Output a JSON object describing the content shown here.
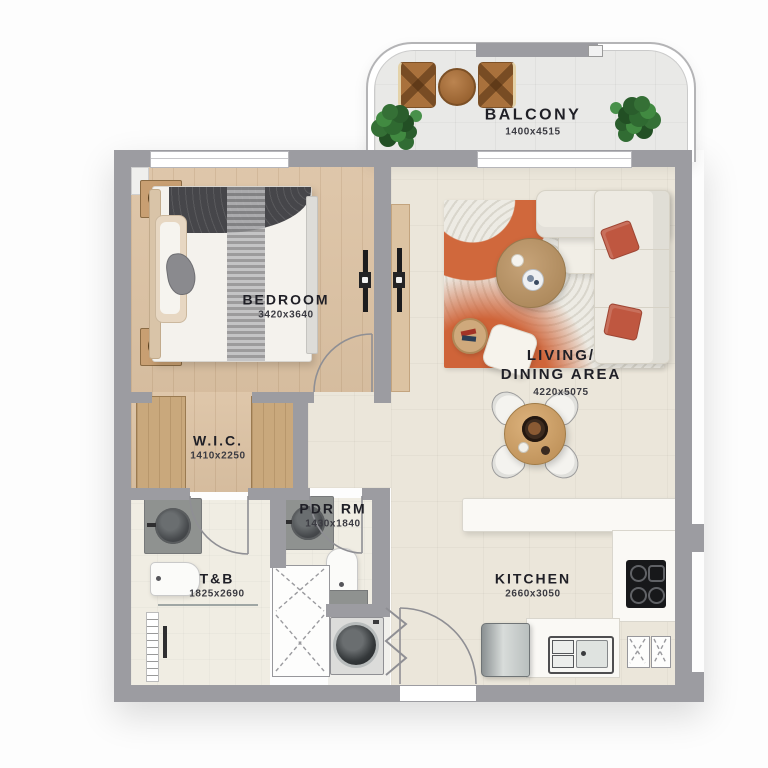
{
  "title": "Apartment floor plan",
  "rooms": {
    "balcony": {
      "label": "BALCONY",
      "dims": "1400x4515"
    },
    "bedroom": {
      "label": "BEDROOM",
      "dims": "3420x3640"
    },
    "living": {
      "label_line1": "LIVING/",
      "label_line2": "DINING AREA",
      "dims": "4220x5075"
    },
    "wic": {
      "label": "W.I.C.",
      "dims": "1410x2250"
    },
    "pdr": {
      "label": "PDR RM",
      "dims": "1430x1840"
    },
    "tb": {
      "label": "T&B",
      "dims": "1825x2690"
    },
    "kitchen": {
      "label": "KITCHEN",
      "dims": "2660x3050"
    }
  },
  "fixtures": [
    "bed",
    "nightstand-lamp",
    "wardrobe",
    "tv",
    "sofa",
    "ottoman",
    "rug",
    "coffee-table",
    "side-table",
    "floor-cushion",
    "dining-table",
    "dining-chair",
    "kitchen-peninsula",
    "cooktop",
    "kitchen-sink",
    "refrigerator",
    "base-cabinet",
    "washing-machine",
    "storage-cabinet",
    "vanity-sink",
    "toilet",
    "shower",
    "balcony-table",
    "balcony-chair",
    "plant",
    "door",
    "window"
  ],
  "colors": {
    "wall": "#9c9ca1",
    "wood_floor": "#dcc2a3",
    "tile_floor": "#ebe6da",
    "bath_floor": "#f0ede3",
    "accent_orange": "#cf6439",
    "pillow_terracotta": "#bf5740",
    "plant_green": "#357036",
    "text": "#1f1f26"
  }
}
